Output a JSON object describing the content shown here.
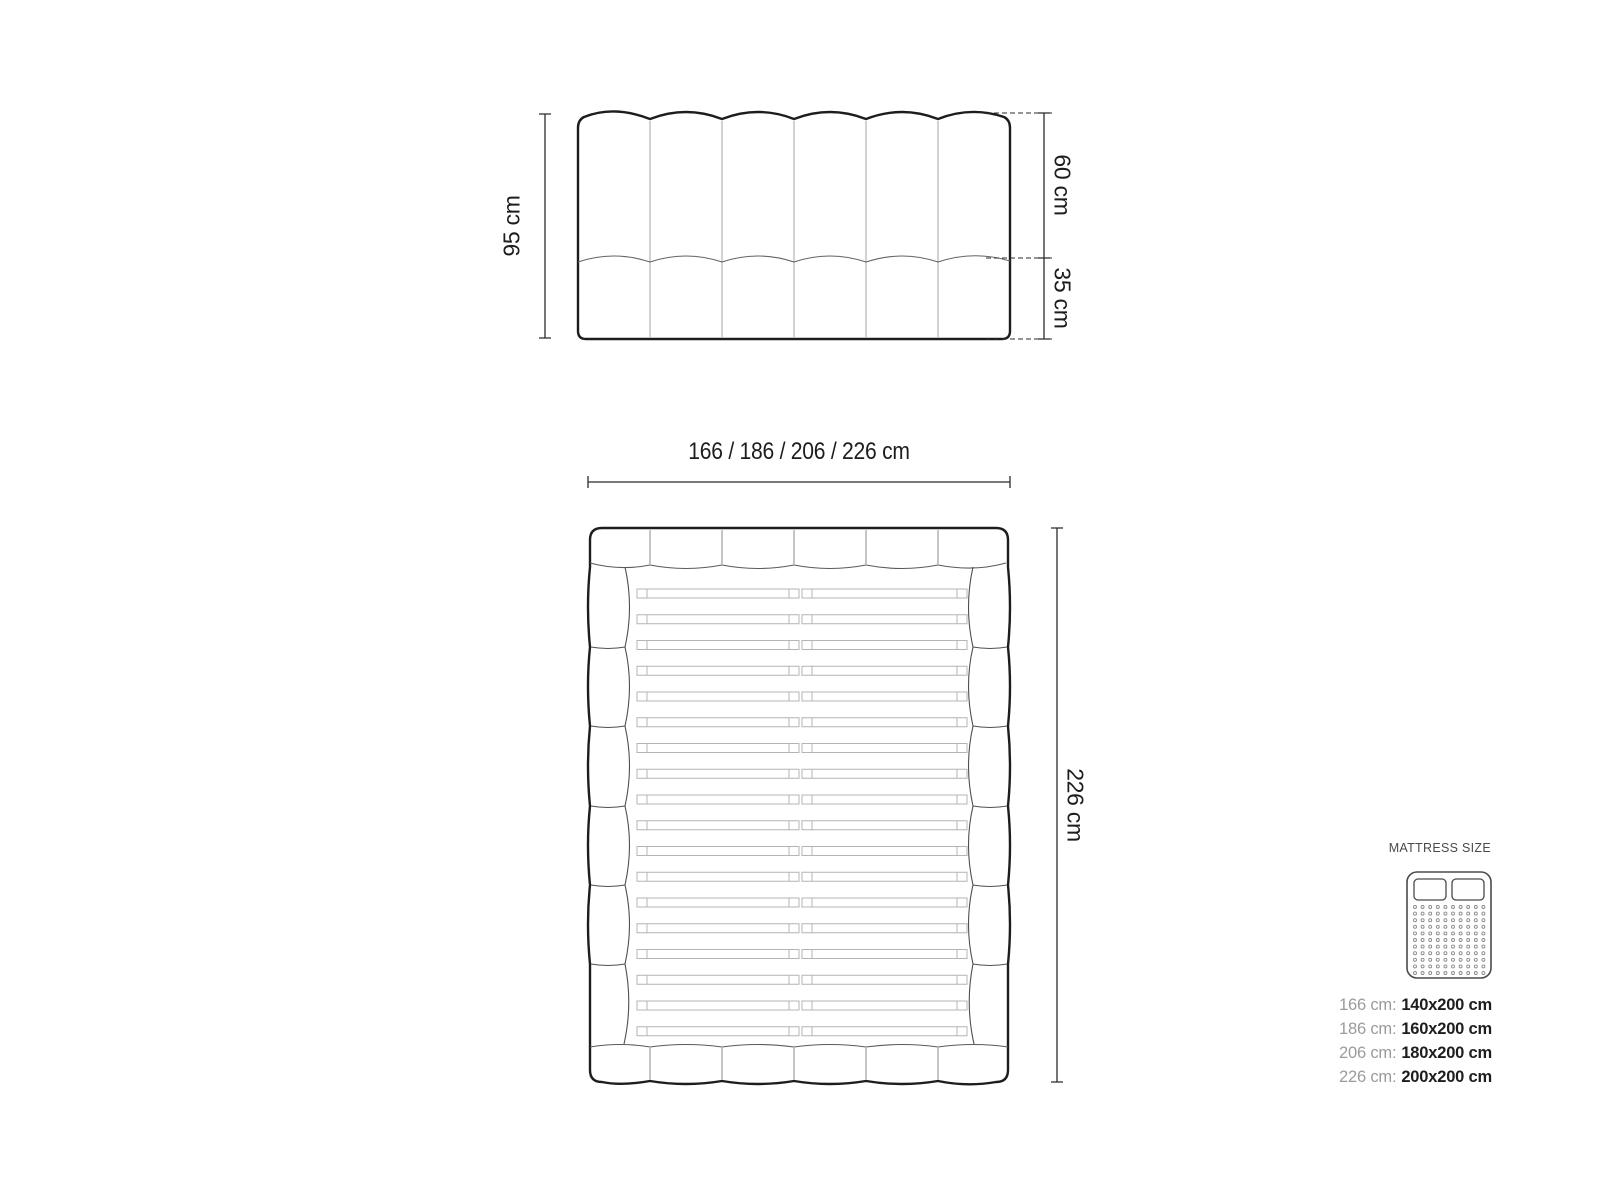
{
  "front_view": {
    "height_label": "95 cm",
    "upper_label": "60 cm",
    "lower_label": "35 cm",
    "channel_count": 6
  },
  "top_view": {
    "width_label": "166 / 186 / 206 / 226 cm",
    "length_label": "226 cm",
    "slat_count": 18,
    "headboard_segment_count": 6,
    "footboard_segment_count": 6
  },
  "legend": {
    "title": "MATTRESS SIZE",
    "icon": "mattress-top-view-icon",
    "rows": [
      {
        "label": "166 cm:",
        "value": "140x200 cm"
      },
      {
        "label": "186 cm:",
        "value": "160x200 cm"
      },
      {
        "label": "206 cm:",
        "value": "180x200 cm"
      },
      {
        "label": "226 cm:",
        "value": "200x200 cm"
      }
    ]
  },
  "colors": {
    "outline_dark": "#1d1d1d",
    "seam_light": "#b5b5b5",
    "line_mid": "#5a5a5a",
    "dimension_line": "#2b2b2b",
    "text_dark": "#1d1d1d",
    "text_gray": "#9b9b9b",
    "background": "#ffffff"
  }
}
